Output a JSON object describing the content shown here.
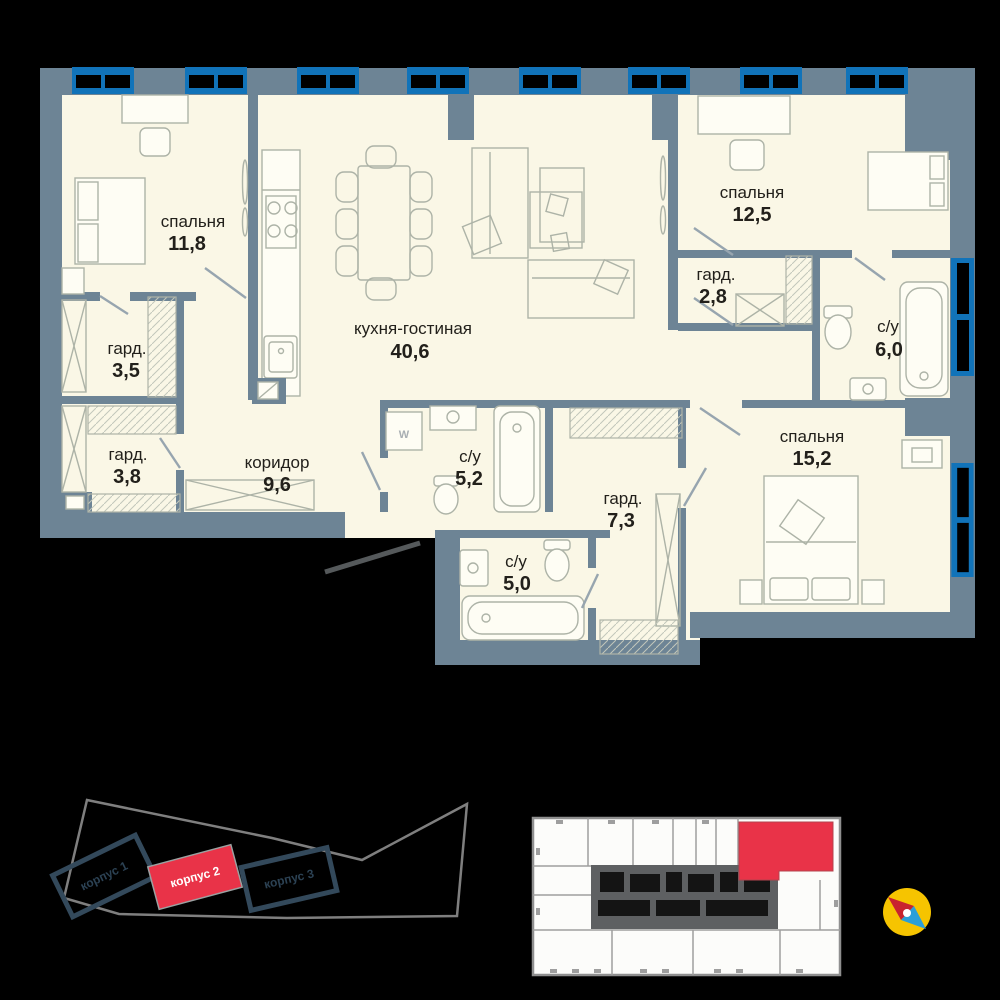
{
  "colors": {
    "background": "#000000",
    "floor": "#FAF7E6",
    "wall": "#6D8495",
    "window_blue": "#1173B9",
    "red": "#E93348",
    "building_navy": "#33495B",
    "site_outline": "#7F7F7F",
    "core_gray": "#5E6062",
    "compass_yellow": "#F6C400",
    "compass_red": "#C8232F",
    "compass_blue": "#2B9FD8"
  },
  "apartment": {
    "washer_label": "W",
    "rooms": [
      {
        "name": "спальня",
        "area": "11,8"
      },
      {
        "name": "гард.",
        "area": "3,5"
      },
      {
        "name": "гард.",
        "area": "3,8"
      },
      {
        "name": "коридор",
        "area": "9,6"
      },
      {
        "name": "кухня-гостиная",
        "area": "40,6"
      },
      {
        "name": "спальня",
        "area": "12,5"
      },
      {
        "name": "гард.",
        "area": "2,8"
      },
      {
        "name": "с/у",
        "area": "6,0"
      },
      {
        "name": "спальня",
        "area": "15,2"
      },
      {
        "name": "гард.",
        "area": "7,3"
      },
      {
        "name": "с/у",
        "area": "5,2"
      },
      {
        "name": "с/у",
        "area": "5,0"
      }
    ]
  },
  "site_plan": {
    "buildings": [
      {
        "label": "корпус 1",
        "highlighted": false
      },
      {
        "label": "корпус 2",
        "highlighted": true
      },
      {
        "label": "корпус 3",
        "highlighted": false
      }
    ]
  }
}
